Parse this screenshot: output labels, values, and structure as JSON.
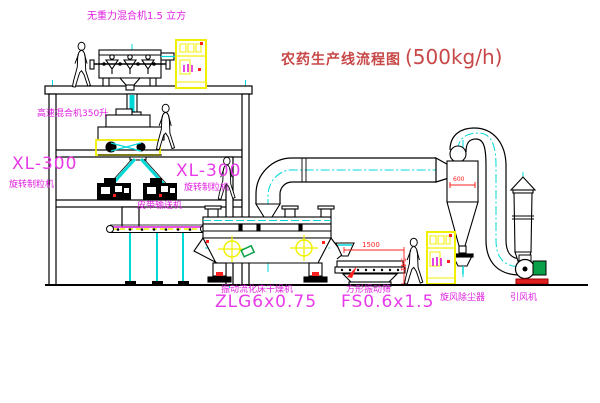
{
  "title": {
    "name_cn": "农药生产线流程图",
    "capacity": "(500kg/h)"
  },
  "labels": {
    "gravity_mixer": "无重力混合机1.5 立方",
    "high_speed_mixer": "高速混合机350升",
    "granulator_left_model": "XL-300",
    "granulator_left_name": "旋转制粒机",
    "granulator_center_model": "XL-300",
    "granulator_center_name": "旋转制粒机",
    "belt_conveyor": "皮带输送机",
    "fluid_bed_dryer_name": "振动流化床干燥机",
    "fluid_bed_dryer_model": "ZLG6x0.75",
    "vibrating_sieve_name": "方形振动筛",
    "vibrating_sieve_model": "FS0.6x1.5",
    "cyclone_dust_collector": "旋风除尘器",
    "induced_draft_fan": "引风机"
  },
  "dimensions": {
    "sieve_length": "1500",
    "sieve_height": "541",
    "cyclone_diameter": "600"
  },
  "colors": {
    "centerline_cyan": "#00d8d8",
    "label_magenta": "#e01ee0",
    "title_red": "#c84848",
    "accent_red": "#ff2020",
    "cabinet_yellow": "#f0f000",
    "motor_green": "#0aa04a",
    "background": "#ffffff"
  }
}
